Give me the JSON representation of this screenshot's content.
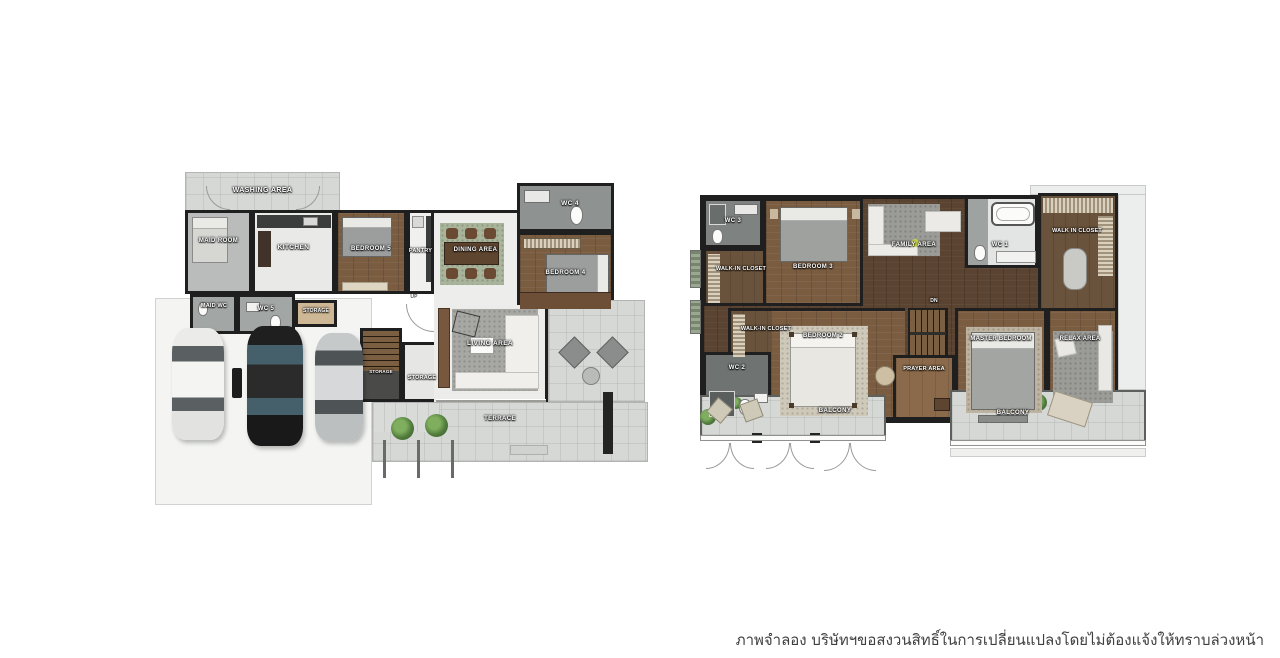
{
  "floor1": {
    "rooms": {
      "washing_area": "WASHING AREA",
      "maid_room": "MAID ROOM",
      "kitchen": "KITCHEN",
      "bedroom5": "BEDROOM 5",
      "pantry": "PANTRY",
      "dining_area": "DINING AREA",
      "wc4": "WC 4",
      "bedroom4": "BEDROOM 4",
      "maid_wc": "MAID WC",
      "wc5": "WC 5",
      "storage_small": "STORAGE",
      "storage_nook": "STORAGE",
      "storage": "STORAGE",
      "up": "UP",
      "living_area": "LIVING AREA",
      "terrace": "TERRACE"
    }
  },
  "floor2": {
    "rooms": {
      "wc3": "WC 3",
      "walk_in_closet_a": "WALK-IN CLOSET",
      "bedroom3": "BEDROOM 3",
      "family_area": "FAMILY AREA",
      "wc1": "WC 1",
      "walk_in_closet_master": "WALK IN CLOSET",
      "dn": "DN",
      "walk_in_closet_b": "WALK-IN CLOSET",
      "wc2": "WC 2",
      "bedroom2": "BEDROOM 2",
      "prayer_area": "PRAYER AREA",
      "master_bedroom": "MASTER BEDROOM",
      "relax_area": "RELAX AREA",
      "balcony_left": "BALCONY",
      "balcony_right": "BALCONY"
    }
  },
  "footer": {
    "disclaimer": "ภาพจำลอง บริษัทฯขอสงวนสิทธิ์ในการเปลี่ยนแปลงโดยไม่ต้องแจ้งให้ทราบล่วงหน้า"
  },
  "colors": {
    "wall": "#1f1f1f",
    "wood_floor": "#7a5c41",
    "wood_dark": "#5a4330",
    "closet_wood": "#6a533c",
    "outdoor_tile": "#d6d8d6",
    "wc_gray": "#848887",
    "interior_light": "#ececea",
    "rug_gray": "#a7a7a3",
    "plant_green": "#6f9b55"
  }
}
